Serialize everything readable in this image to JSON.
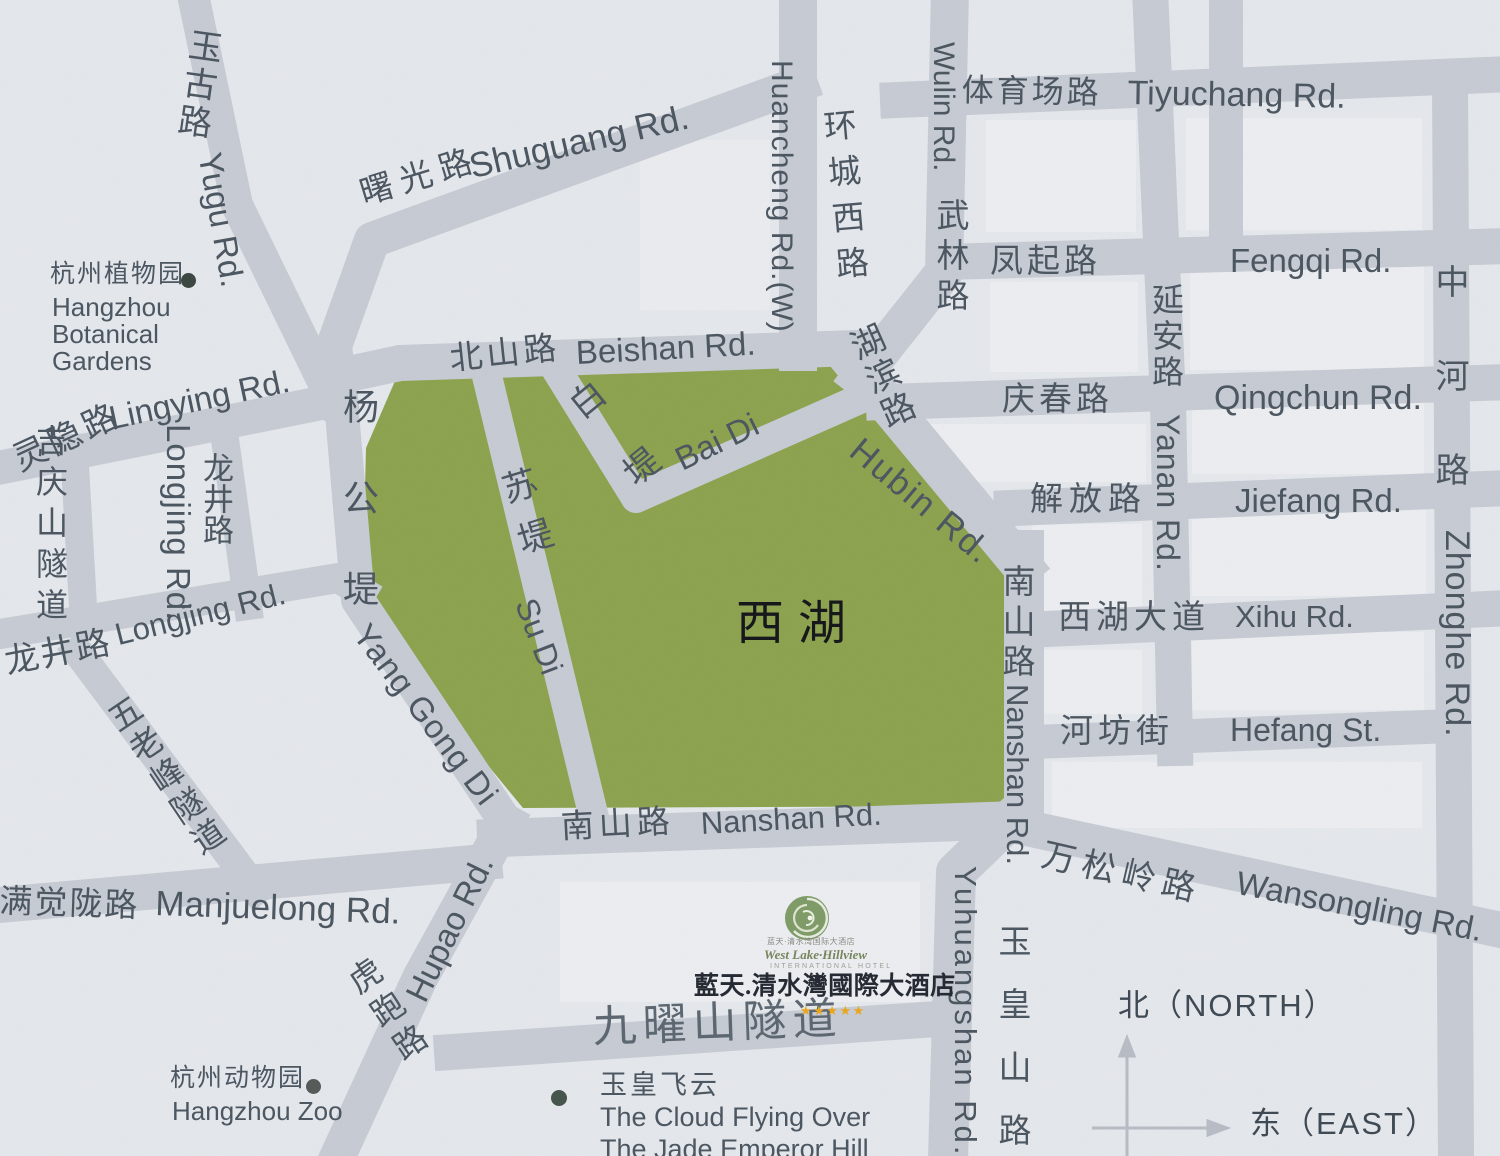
{
  "colors": {
    "background": "#e4e7eb",
    "road": "#c6cad3",
    "lake_green": "#8ca24d",
    "label_slate": "#4c5762",
    "dark_text": "#17181c",
    "star_gold": "#e8a61c",
    "logo_green": "#7f9b68"
  },
  "lake": {
    "name": "西湖"
  },
  "labels": {
    "yugu_cn": "玉古路",
    "yugu_en": "Yugu Rd.",
    "shuguang_cn": "曙光路",
    "shuguang_en": "Shuguang Rd.",
    "huancheng_cn": "环城西路",
    "huancheng_en": "Huancheng Rd.(W)",
    "wulin_cn": "武林路",
    "wulin_en": "Wulin Rd.",
    "tiyuchang_cn": "体育场路",
    "tiyuchang_en": "Tiyuchang Rd.",
    "fengqi_cn": "凤起路",
    "fengqi_en": "Fengqi Rd.",
    "yanan_cn": "延安路",
    "yanan_en": "Yanan Rd.",
    "qingchun_cn": "庆春路",
    "qingchun_en": "Qingchun Rd.",
    "zhonghe_cn": "中河路",
    "zhonghe_en": "Zhonghe Rd.",
    "jiefang_cn": "解放路",
    "jiefang_en": "Jiefang Rd.",
    "xihu_cn": "西湖大道",
    "xihu_en": "Xihu Rd.",
    "hefang_cn": "河坊街",
    "hefang_en": "Hefang St.",
    "beishan_cn": "北山路",
    "beishan_en": "Beishan Rd.",
    "baidi_cn": "白堤",
    "baidi_en": "Bai Di",
    "sudi_cn": "苏堤",
    "sudi_en": "Su Di",
    "yanggongdi_cn": "杨公堤",
    "yanggongdi_en": "Yang Gong Di",
    "hubin_cn": "湖滨路",
    "hubin_en": "Hubin Rd.",
    "nanshan_v_cn": "南山路",
    "nanshan_v_en": "Nanshan Rd.",
    "nanshan_h_cn": "南山路",
    "nanshan_h_en": "Nanshan Rd.",
    "wansongling_cn": "万松岭路",
    "wansongling_en": "Wansongling Rd.",
    "yuhuangshan_cn": "玉皇山路",
    "yuhuangshan_en": "Yuhuangshan Rd.",
    "lingying_cn": "灵隐路",
    "lingying_en": "Lingying Rd.",
    "jiqingshan_tunnel_cn": "吉庆山隧道",
    "longjing_v_cn": "龙井路",
    "longjing_v_en": "Longjing Rd.",
    "longjing_h_cn": "龙井路",
    "longjing_h_en": "Longjing Rd.",
    "wulaofeng_tunnel_cn": "五老峰隧道",
    "manjuelong_cn": "满觉陇路",
    "manjuelong_en": "Manjuelong Rd.",
    "hupao_cn": "虎跑路",
    "hupao_en": "Hupao Rd.",
    "jiuyaoshan_tunnel_cn": "九曜山隧道"
  },
  "pois": {
    "botanical_cn": "杭州植物园",
    "botanical_en_1": "Hangzhou",
    "botanical_en_2": "Botanical",
    "botanical_en_3": "Gardens",
    "zoo_cn": "杭州动物园",
    "zoo_en": "Hangzhou Zoo",
    "jade_cn": "玉皇飞云",
    "jade_en_1": "The Cloud Flying Over",
    "jade_en_2": "The Jade Emperor Hill"
  },
  "hotel": {
    "small_cn": "蓝天·清水湾国际大酒店",
    "script": "West Lake·Hillview",
    "intl": "INTERNATIONAL HOTEL",
    "name": "藍天.清水灣國際大酒店",
    "stars": "★★★★★"
  },
  "compass": {
    "north": "北（NORTH）",
    "east": "东（EAST）"
  }
}
